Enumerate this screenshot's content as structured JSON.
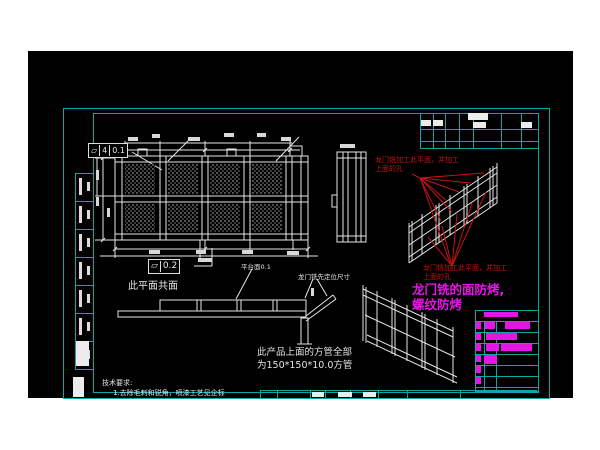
{
  "colors": {
    "canvas_bg": "#000000",
    "frame_teal": "#0da6a6",
    "linework_white": "#e6e6e6",
    "annotation_red": "#c41414",
    "annotation_magenta": "#ea14ea"
  },
  "annotations": {
    "fcf_top": {
      "symbol": "▱",
      "zones": "4",
      "value": "0.1"
    },
    "fcf_coplanar": {
      "symbol": "▱",
      "value": "0.2"
    },
    "coplanar_note": "此平面共面",
    "platform_note": "平台面0.1",
    "locating_note": "龙门铣先定位尺寸",
    "red_note": {
      "line1": "龙门铣加工此平面，并加工",
      "line2": "上面的孔"
    },
    "magenta_note": {
      "line1": "龙门铣的面防烤,",
      "line2": "螺纹防烤"
    },
    "tube_note": {
      "line1": "此产品上面的方管全部",
      "line2": "为150*150*10.0方管"
    },
    "tech_req": {
      "title": "技术要求:",
      "item1": "1.去除毛刺和锐角，喷漆工艺见企标"
    }
  },
  "left_margin": {
    "cells": 7
  },
  "parts_table": {
    "bars": [
      {
        "x": 484,
        "y": 312,
        "w": 34,
        "h": 5
      },
      {
        "x": 476,
        "y": 322,
        "w": 5,
        "h": 7
      },
      {
        "x": 485,
        "y": 322,
        "w": 10,
        "h": 7
      },
      {
        "x": 505,
        "y": 322,
        "w": 25,
        "h": 7
      },
      {
        "x": 476,
        "y": 333,
        "w": 5,
        "h": 7
      },
      {
        "x": 486,
        "y": 333,
        "w": 31,
        "h": 7
      },
      {
        "x": 476,
        "y": 344,
        "w": 5,
        "h": 7
      },
      {
        "x": 486,
        "y": 344,
        "w": 13,
        "h": 7
      },
      {
        "x": 501,
        "y": 344,
        "w": 31,
        "h": 7
      },
      {
        "x": 476,
        "y": 355,
        "w": 5,
        "h": 7
      },
      {
        "x": 484,
        "y": 355,
        "w": 13,
        "h": 9
      },
      {
        "x": 476,
        "y": 366,
        "w": 5,
        "h": 7
      },
      {
        "x": 476,
        "y": 377,
        "w": 5,
        "h": 7
      }
    ]
  }
}
